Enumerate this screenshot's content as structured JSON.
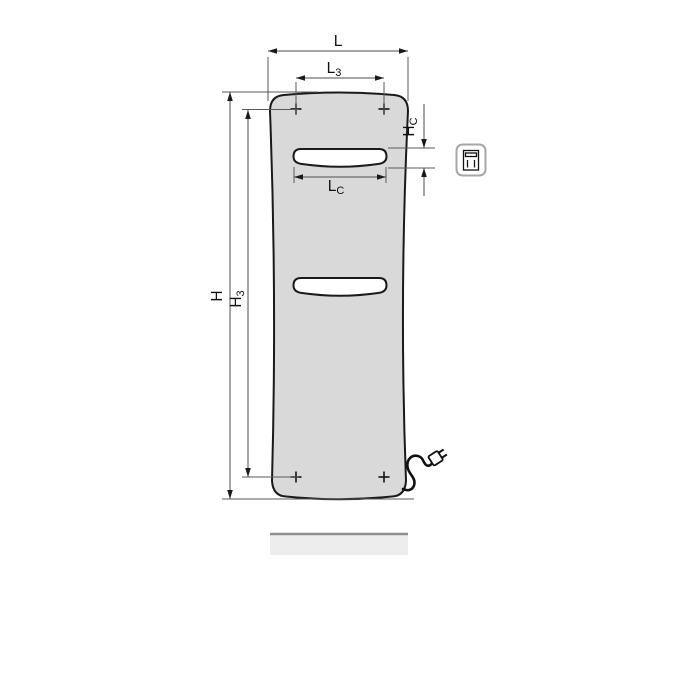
{
  "title": "Panel radiator dimensional drawing",
  "labels": {
    "L": {
      "base": "L",
      "sub": ""
    },
    "L3": {
      "base": "L",
      "sub": "3"
    },
    "LC": {
      "base": "L",
      "sub": "C"
    },
    "H": {
      "base": "H",
      "sub": ""
    },
    "H3": {
      "base": "H",
      "sub": "3"
    },
    "HC": {
      "base": "H",
      "sub": "C"
    }
  },
  "icons": {
    "electrical_pictogram": "panel-radiator-with-slot-icon",
    "plug": "power-plug-icon",
    "mounting_point": "cross-marker"
  },
  "colors": {
    "panel_fill": "#d9d9d9",
    "slot_fill": "#ffffff",
    "outline": "#1a1a1a",
    "dimension_lines": "#4d4d4d",
    "floor_bar_fill": "#ededed",
    "floor_bar_edge": "#8f8f8f",
    "icon_border": "#a6a6a6"
  }
}
